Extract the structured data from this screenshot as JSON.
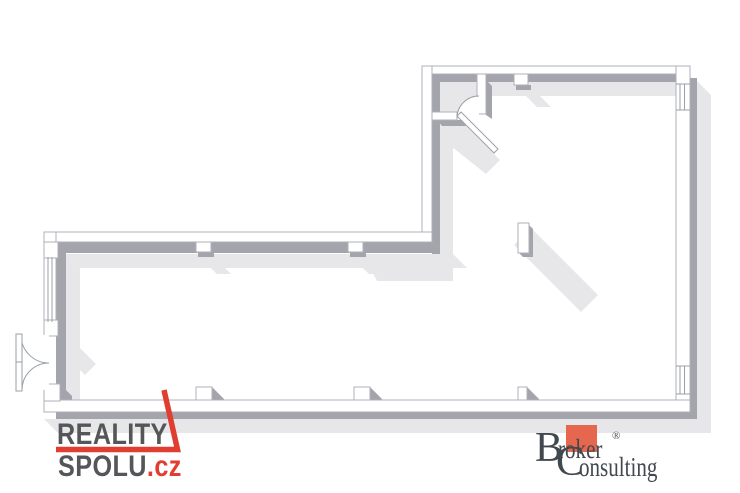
{
  "canvas": {
    "width": 740,
    "height": 493,
    "background": "#ffffff"
  },
  "floor_plan": {
    "description": "L-shaped open commercial space, pseudo-3D top-down floor plan, no text labels",
    "elements": [
      "exterior-walls",
      "entry-double-door-left-wall",
      "vestibule-room-top-left",
      "interior-door-with-swing-arc",
      "window-left-wall",
      "window-right-wall-top",
      "window-right-wall-bottom",
      "wall-pillar-notches",
      "bottom-wall-pillars",
      "free-standing-column-with-shadow"
    ]
  },
  "palette": {
    "wall_white": "#ffffff",
    "wall_side_gray": "#a4a4ac",
    "wall_outline": "#b0b0b8",
    "shadow_light": "#e7e7ea",
    "accent_red": "#e03e30",
    "broker_square": "#e5674e"
  },
  "logos": {
    "reality_spolu": {
      "line1": "REALITY",
      "line2": "SPOLU",
      "tld": ".cz",
      "text_color": "#545659",
      "accent_color": "#e03e30"
    },
    "broker_consulting": {
      "b": "B",
      "roker": "roker",
      "registered": "®",
      "c": "C",
      "onsulting": "onsulting",
      "text_color": "#41484e",
      "square_color": "#e5674e"
    }
  }
}
